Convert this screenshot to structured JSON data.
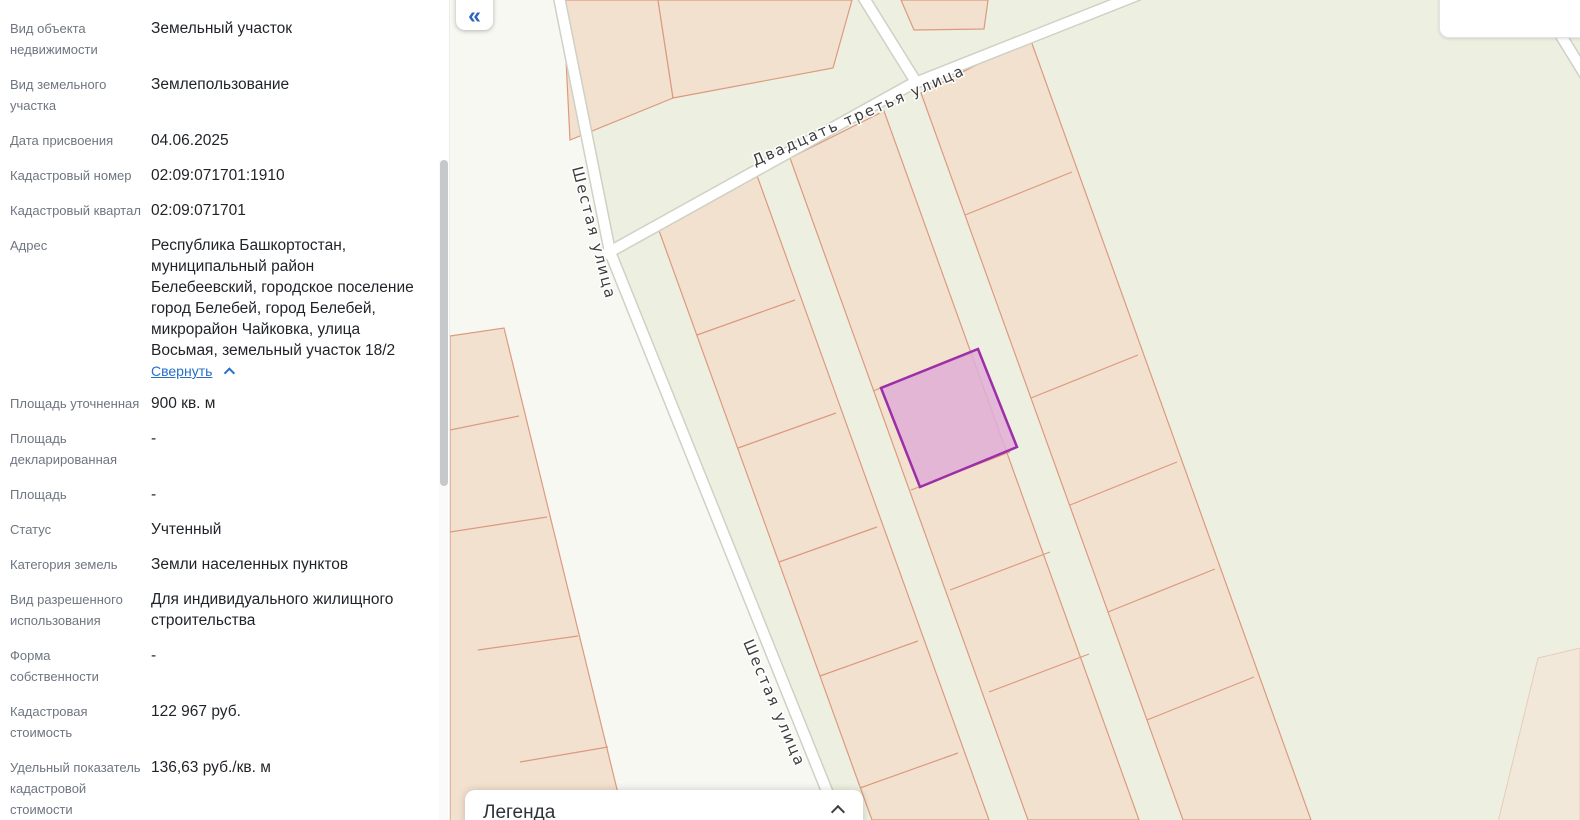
{
  "sidebar": {
    "rows": [
      {
        "label": "Вид объекта недвижимости",
        "value": "Земельный участок"
      },
      {
        "label": "Вид земельного участка",
        "value": "Землепользование"
      },
      {
        "label": "Дата присвоения",
        "value": "04.06.2025"
      },
      {
        "label": "Кадастровый номер",
        "value": "02:09:071701:1910"
      },
      {
        "label": "Кадастровый квартал",
        "value": "02:09:071701"
      },
      {
        "label": "Адрес",
        "value": "Республика Башкортостан, муниципальный район Белебеевский, городское поселение город Белебей, город Белебей, микрорайон Чайковка, улица Восьмая, земельный участок 18/2",
        "collapse_label": "Свернуть"
      },
      {
        "label": "Площадь уточненная",
        "value": "900 кв. м"
      },
      {
        "label": "Площадь декларированная",
        "value": "-"
      },
      {
        "label": "Площадь",
        "value": "-"
      },
      {
        "label": "Статус",
        "value": "Учтенный"
      },
      {
        "label": "Категория земель",
        "value": "Земли населенных пунктов"
      },
      {
        "label": "Вид разрешенного использования",
        "value": "Для индивидуального жилищного строительства"
      },
      {
        "label": "Форма собственности",
        "value": "-"
      },
      {
        "label": "Кадастровая стоимость",
        "value": "122 967 руб."
      },
      {
        "label": "Удельный показатель кадастровой стоимости",
        "value": "136,63 руб./кв. м"
      }
    ]
  },
  "map": {
    "collapse_button": "«",
    "legend": {
      "title": "Легенда"
    },
    "streets": {
      "street_23": "Двадцать третья улица",
      "street_6_upper": "Шестая улица",
      "street_6_lower": "Шестая улица"
    },
    "colors": {
      "background": "#edf0e0",
      "road_corridor": "#f7f8f2",
      "parcel_fill": "#f3e1cf",
      "parcel_border": "#dc9a7f",
      "road_fill": "#ffffff",
      "highlight_fill": "#e0aed6",
      "highlight_border": "#9c2fa8"
    }
  }
}
